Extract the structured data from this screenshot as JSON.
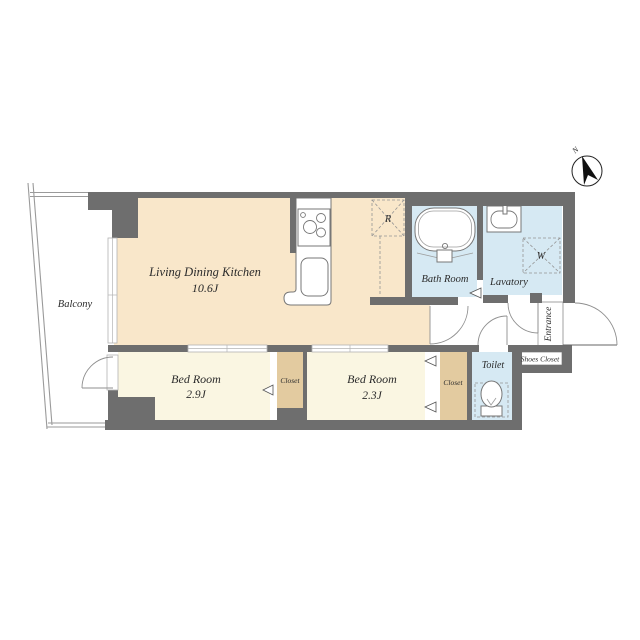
{
  "palette": {
    "wall": "#6e6e6e",
    "ldk_floor": "#f9e7ca",
    "bedroom_floor": "#faf6e2",
    "closet_floor": "#e3cba0",
    "wet_floor": "#d6e9f3"
  },
  "plan": {
    "north_indicator": {
      "label": "N"
    },
    "balcony": {
      "label": "Balcony"
    },
    "living_dining_kitchen": {
      "label": "Living Dining Kitchen",
      "size": "10.6J"
    },
    "bedroom1": {
      "label": "Bed Room",
      "size": "2.9J"
    },
    "bedroom2": {
      "label": "Bed Room",
      "size": "2.3J"
    },
    "bath": {
      "label": "Bath Room"
    },
    "lavatory": {
      "label": "Lavatory"
    },
    "toilet": {
      "label": "Toilet"
    },
    "entrance": {
      "label": "Entrance"
    },
    "shoes_closet": {
      "label": "Shoes Closet"
    },
    "closet1": {
      "label": "Closet"
    },
    "closet2": {
      "label": "Closet"
    },
    "refrigerator_space": {
      "label": "R"
    },
    "washer_space": {
      "label": "W"
    }
  }
}
